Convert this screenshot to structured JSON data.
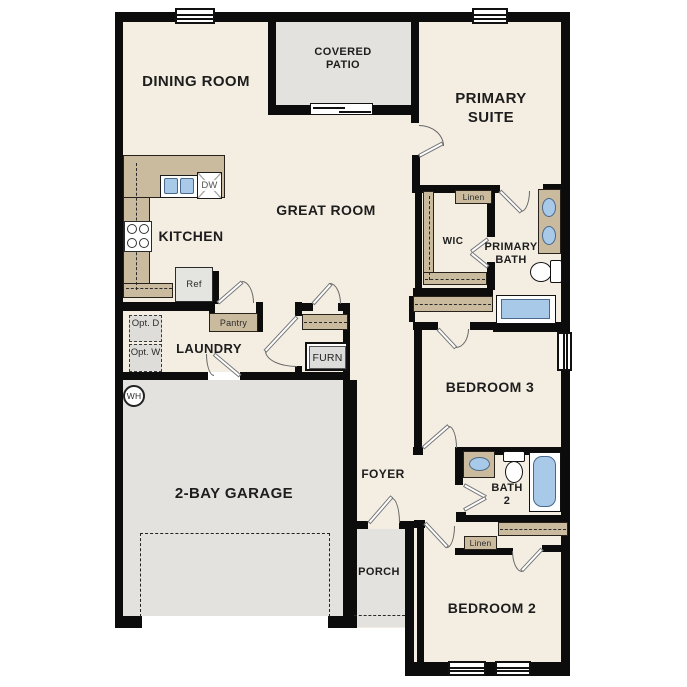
{
  "plan_title": "single-story floor plan",
  "rooms": {
    "dining": {
      "label": "DINING ROOM"
    },
    "patio": {
      "label": "COVERED PATIO"
    },
    "primary": {
      "label": "PRIMARY SUITE"
    },
    "kitchen": {
      "label": "KITCHEN"
    },
    "great": {
      "label": "GREAT ROOM"
    },
    "wic": {
      "label": "WIC"
    },
    "primary_bath": {
      "label": "PRIMARY BATH"
    },
    "laundry": {
      "label": "LAUNDRY"
    },
    "bedroom3": {
      "label": "BEDROOM 3"
    },
    "garage": {
      "label": "2-BAY GARAGE"
    },
    "foyer": {
      "label": "FOYER"
    },
    "bath2": {
      "label": "BATH 2"
    },
    "porch": {
      "label": "PORCH"
    },
    "bedroom2": {
      "label": "BEDROOM 2"
    }
  },
  "fixtures": {
    "ref": {
      "label": "Ref"
    },
    "dw": {
      "label": "DW"
    },
    "pantry": {
      "label": "Pantry"
    },
    "furn": {
      "label": "FURN"
    },
    "linen_primary": {
      "label": "Linen"
    },
    "linen_hall": {
      "label": "Linen"
    },
    "water_heater": {
      "label": "WH"
    },
    "opt_dryer": {
      "label": "Opt. D"
    },
    "opt_washer": {
      "label": "Opt. W"
    }
  },
  "colors": {
    "wall": "#0c0c0c",
    "floor": "#f4eee2",
    "exterior_surface": "#e3e2de",
    "cabinet_tan": "#cabb9e",
    "fixture_blue": "#a9c9e9"
  }
}
